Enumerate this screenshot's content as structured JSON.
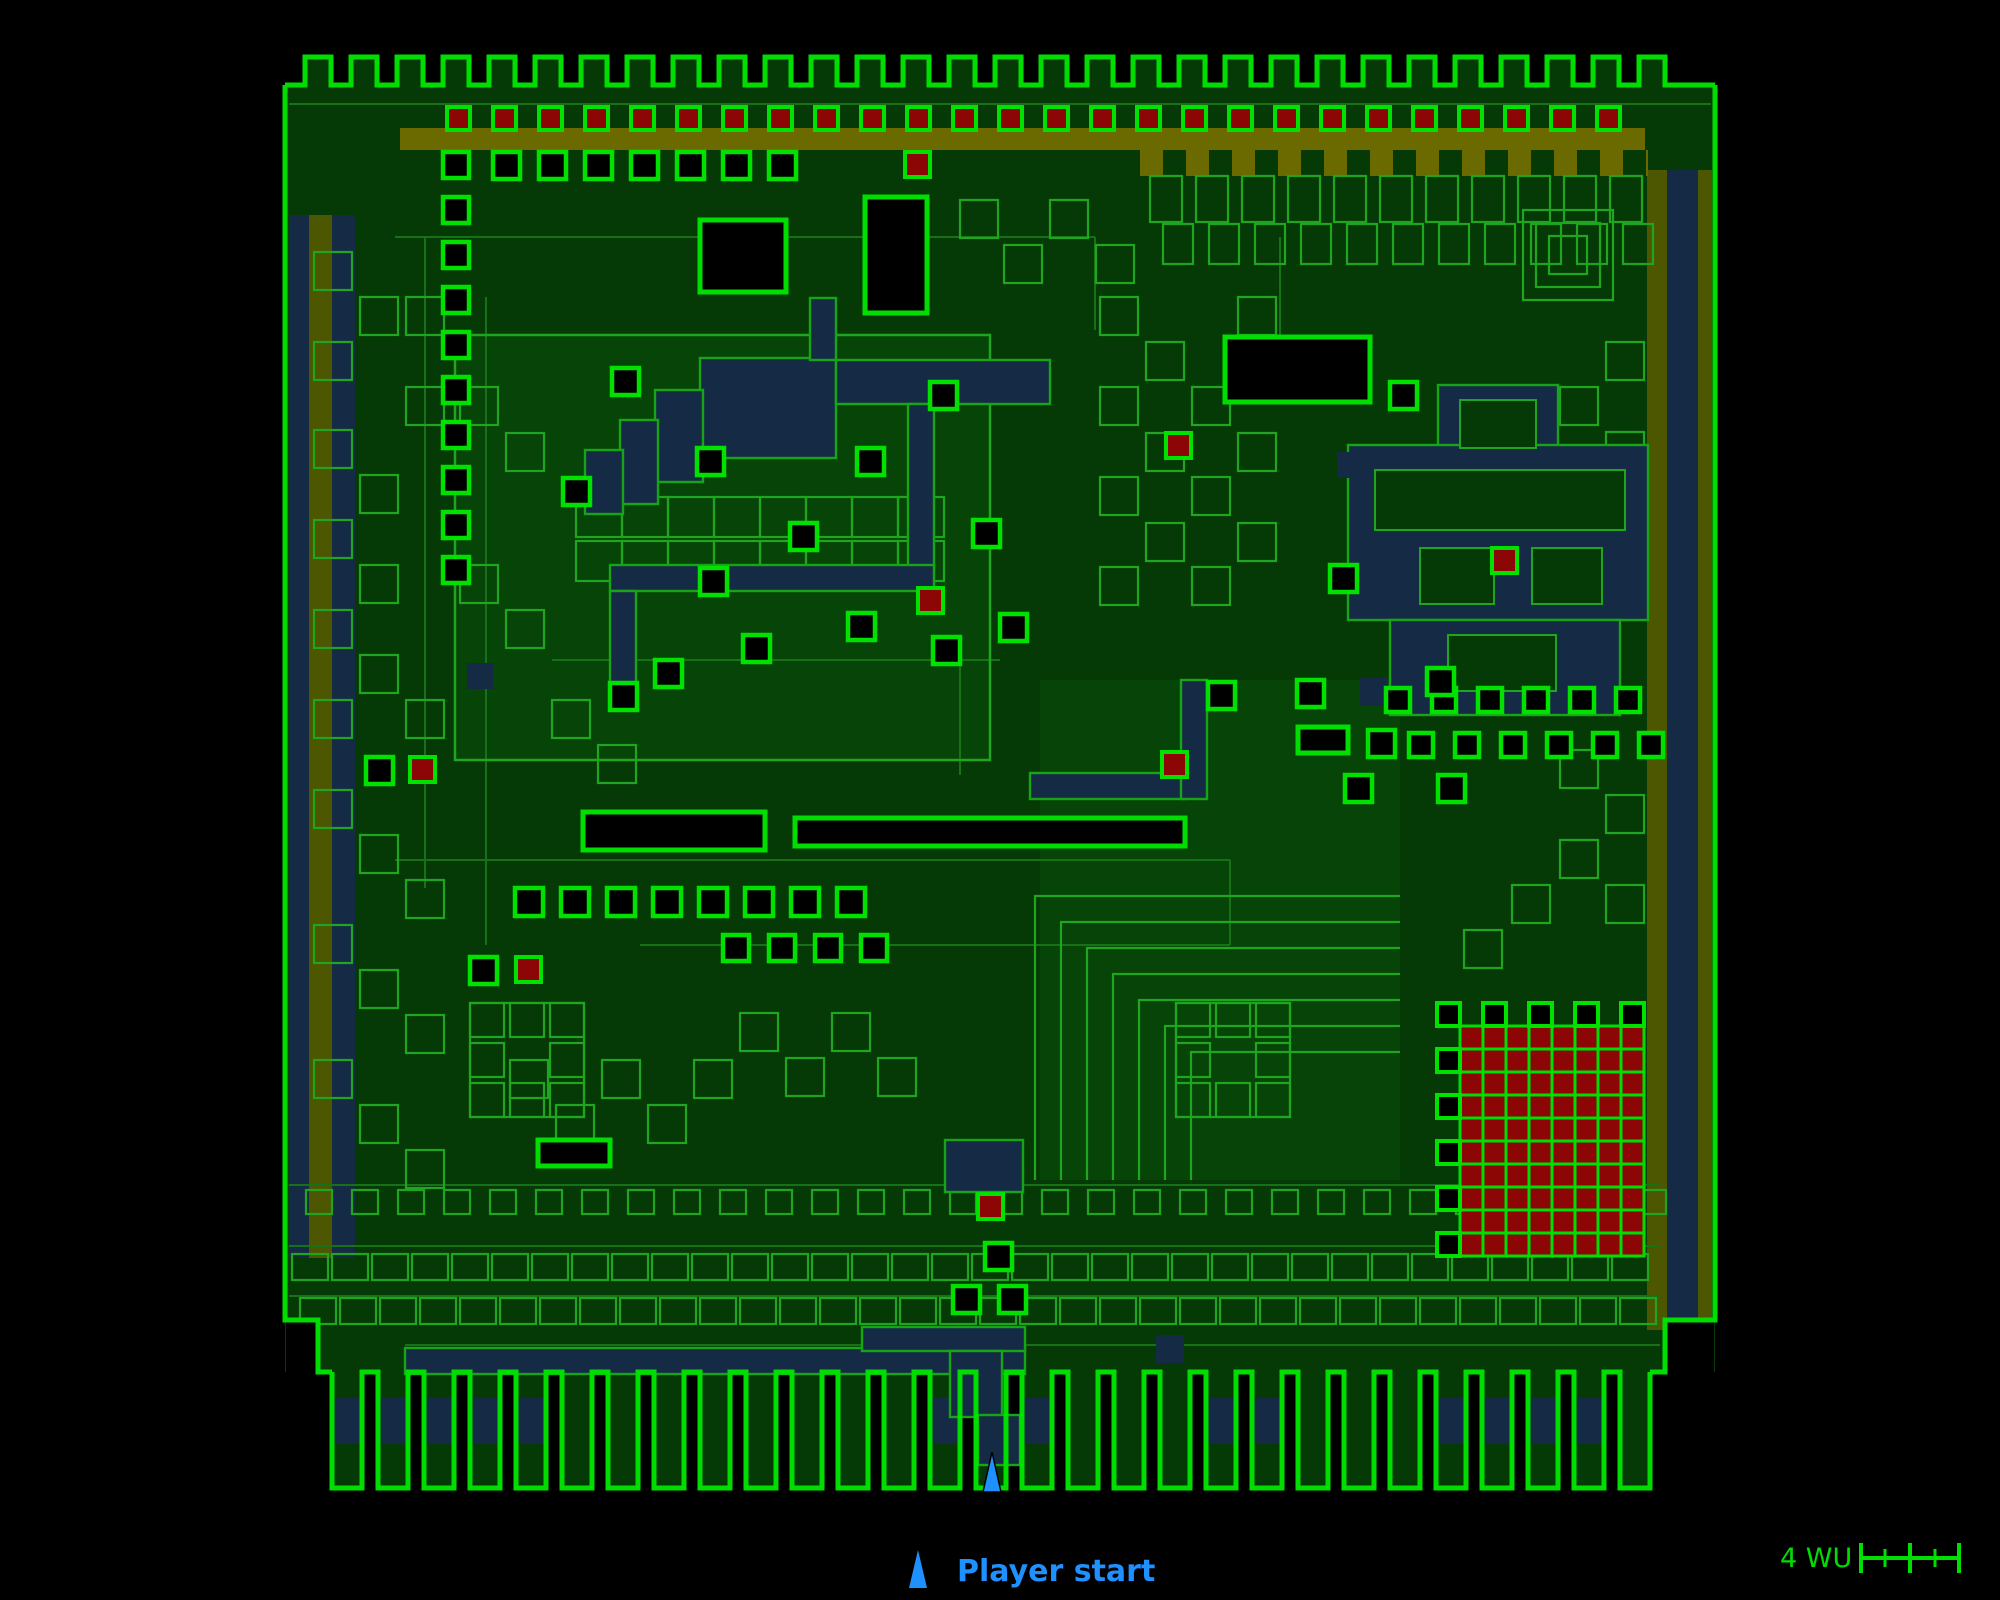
{
  "legend": {
    "label": "Player start"
  },
  "scalebar": {
    "label": "4 WU"
  },
  "map": {
    "colors": {
      "bg": "#000000",
      "floor": "#053a06",
      "floor_alt": "#064408",
      "bright": "#00dd00",
      "item_edge": "#00e100",
      "mid": "#1fa51f",
      "dim": "#177117",
      "water": "#152a45",
      "water_edge": "#17a517",
      "olive_band": "#6a6a00",
      "olive_strip": "#4d5600",
      "red": "#8d0606",
      "blue": "#1e90ff"
    },
    "frame": {
      "x": 285,
      "y": 85,
      "w": 1430,
      "h": 1287
    },
    "patches": [
      [
        455,
        335,
        535,
        425
      ],
      [
        1040,
        680,
        360,
        500
      ]
    ],
    "crenellation": {
      "x0": 285,
      "x1": 1715,
      "y_top": 57,
      "y_base": 85,
      "pitch": 46,
      "tab_w": 26,
      "lead": 20
    },
    "comb": {
      "x0": 332,
      "count": 29,
      "pitch": 46,
      "tooth_w": 30,
      "y_top": 1372,
      "y_bot": 1488,
      "band_y": 1398,
      "band_h": 46,
      "band_segments": [
        [
          335,
          565
        ],
        [
          900,
          1045
        ],
        [
          1180,
          1305
        ],
        [
          1440,
          1625
        ]
      ]
    },
    "strips": [
      [
        289,
        215,
        66,
        1043,
        "water"
      ],
      [
        309,
        215,
        23,
        1043,
        "olive_strip"
      ],
      [
        1647,
        170,
        20,
        1160,
        "olive_strip"
      ],
      [
        1667,
        170,
        31,
        1160,
        "water"
      ],
      [
        1698,
        170,
        14,
        1160,
        "olive_strip"
      ],
      [
        400,
        128,
        1245,
        22,
        "olive_band"
      ],
      [
        1140,
        150,
        508,
        26,
        "olive_band"
      ]
    ],
    "fringe_tabs": {
      "x0": 1163,
      "y": 150,
      "w": 23,
      "h": 26,
      "step": 46,
      "count": 11
    },
    "dim_lines": [
      [
        289,
        104,
        1711,
        104
      ],
      [
        425,
        237,
        425,
        888
      ],
      [
        486,
        297,
        486,
        945
      ],
      [
        395,
        237,
        1095,
        237
      ],
      [
        1095,
        237,
        1095,
        330
      ],
      [
        552,
        660,
        1000,
        660
      ],
      [
        395,
        860,
        1230,
        860
      ],
      [
        1230,
        860,
        1230,
        945
      ],
      [
        640,
        945,
        1230,
        945
      ],
      [
        289,
        1185,
        1660,
        1185
      ],
      [
        289,
        1246,
        1660,
        1246
      ],
      [
        289,
        1296,
        1660,
        1296
      ],
      [
        405,
        1345,
        1660,
        1345
      ],
      [
        960,
        660,
        960,
        775
      ],
      [
        1280,
        237,
        1280,
        337
      ]
    ],
    "compound_box": [
      455,
      335,
      535,
      425
    ],
    "dim_rows": [
      {
        "y": 176,
        "x0": 1150,
        "step": 46,
        "w": 32,
        "h": 46,
        "count": 11
      },
      {
        "y": 224,
        "x0": 1163,
        "step": 46,
        "w": 30,
        "h": 40,
        "count": 11
      },
      {
        "y": 497,
        "x0": 576,
        "step": 46,
        "w": 46,
        "h": 40,
        "count": 8
      },
      {
        "y": 541,
        "x0": 576,
        "step": 46,
        "w": 46,
        "h": 40,
        "count": 8
      },
      {
        "y": 1190,
        "x0": 306,
        "step": 46,
        "w": 26,
        "h": 24,
        "count": 30
      },
      {
        "y": 1254,
        "x0": 292,
        "step": 40,
        "w": 36,
        "h": 26,
        "count": 34
      },
      {
        "y": 1298,
        "x0": 300,
        "step": 40,
        "w": 36,
        "h": 26,
        "count": 34
      }
    ],
    "dim_squares": [
      [
        314,
        252
      ],
      [
        314,
        342
      ],
      [
        360,
        297
      ],
      [
        314,
        430
      ],
      [
        360,
        475
      ],
      [
        406,
        297
      ],
      [
        406,
        387
      ],
      [
        314,
        520
      ],
      [
        360,
        565
      ],
      [
        314,
        610
      ],
      [
        360,
        655
      ],
      [
        406,
        700
      ],
      [
        314,
        700
      ],
      [
        314,
        790
      ],
      [
        360,
        835
      ],
      [
        406,
        880
      ],
      [
        314,
        925
      ],
      [
        360,
        970
      ],
      [
        406,
        1015
      ],
      [
        314,
        1060
      ],
      [
        360,
        1105
      ],
      [
        406,
        1150
      ],
      [
        460,
        387
      ],
      [
        506,
        433
      ],
      [
        460,
        565
      ],
      [
        506,
        610
      ],
      [
        552,
        700
      ],
      [
        598,
        745
      ],
      [
        510,
        1060
      ],
      [
        556,
        1105
      ],
      [
        602,
        1060
      ],
      [
        648,
        1105
      ],
      [
        694,
        1060
      ],
      [
        740,
        1013
      ],
      [
        786,
        1058
      ],
      [
        832,
        1013
      ],
      [
        878,
        1058
      ],
      [
        1100,
        297
      ],
      [
        1146,
        342
      ],
      [
        1192,
        387
      ],
      [
        1238,
        297
      ],
      [
        1100,
        387
      ],
      [
        1146,
        433
      ],
      [
        1238,
        433
      ],
      [
        1100,
        477
      ],
      [
        1192,
        477
      ],
      [
        1146,
        523
      ],
      [
        1238,
        523
      ],
      [
        1100,
        567
      ],
      [
        1192,
        567
      ],
      [
        1606,
        342
      ],
      [
        1560,
        387
      ],
      [
        1606,
        432
      ],
      [
        1560,
        750
      ],
      [
        1606,
        795
      ],
      [
        1560,
        840
      ],
      [
        1512,
        885
      ],
      [
        1464,
        930
      ],
      [
        1606,
        885
      ],
      [
        1050,
        200
      ],
      [
        1096,
        245
      ],
      [
        960,
        200
      ],
      [
        1004,
        245
      ],
      [
        1523,
        210,
        90
      ],
      [
        1536,
        223,
        64
      ],
      [
        1549,
        236,
        38
      ]
    ],
    "rings": [
      [
        470,
        1003,
        114
      ],
      [
        1176,
        1003,
        114
      ]
    ],
    "nested_corners": {
      "x0": 1035,
      "y0": 896,
      "x_right": 1400,
      "y_bot": 1180,
      "step": 26,
      "count": 7
    },
    "water": [
      [
        700,
        358,
        136,
        100
      ],
      [
        655,
        390,
        48,
        92
      ],
      [
        620,
        420,
        38,
        84
      ],
      [
        585,
        450,
        38,
        64
      ],
      [
        810,
        298,
        26,
        62
      ],
      [
        836,
        360,
        214,
        44
      ],
      [
        908,
        404,
        26,
        165
      ],
      [
        610,
        565,
        324,
        26
      ],
      [
        610,
        591,
        26,
        112
      ],
      [
        1030,
        773,
        155,
        26
      ],
      [
        1181,
        680,
        26,
        119
      ],
      [
        1438,
        385,
        120,
        325
      ],
      [
        1348,
        445,
        300,
        175
      ],
      [
        1390,
        620,
        230,
        95
      ],
      [
        405,
        1348,
        620,
        26
      ],
      [
        862,
        1327,
        163,
        24
      ],
      [
        950,
        1351,
        52,
        66
      ],
      [
        978,
        1415,
        42,
        50
      ],
      [
        945,
        1140,
        78,
        52
      ]
    ],
    "water_plain": [
      [
        467,
        663,
        26,
        26
      ],
      [
        1337,
        452,
        26,
        26
      ],
      [
        1360,
        678,
        28,
        28
      ],
      [
        1156,
        1335,
        28,
        28
      ]
    ],
    "islands": [
      [
        1460,
        400,
        76,
        48
      ],
      [
        1375,
        470,
        250,
        60
      ],
      [
        1420,
        548,
        74,
        56
      ],
      [
        1532,
        548,
        70,
        56
      ],
      [
        1448,
        635,
        108,
        56
      ]
    ],
    "holes": [
      [
        700,
        220,
        86,
        72
      ],
      [
        865,
        197,
        62,
        116
      ],
      [
        1225,
        337,
        145,
        65
      ],
      [
        583,
        812,
        182,
        38
      ],
      [
        795,
        818,
        390,
        28
      ],
      [
        1298,
        727,
        50,
        26
      ],
      [
        538,
        1140,
        72,
        26
      ]
    ],
    "red_row": {
      "x0": 447,
      "y": 107,
      "size": 23,
      "step": 46,
      "count": 26
    },
    "item_rows": [
      {
        "x0": 493,
        "y": 152,
        "step": 46,
        "count": 7,
        "size": 27
      },
      {
        "x0": 1386,
        "y": 688,
        "step": 46,
        "count": 6,
        "size": 24
      },
      {
        "x0": 1409,
        "y": 733,
        "step": 46,
        "count": 6,
        "size": 24
      },
      {
        "x0": 515,
        "y": 888,
        "step": 46,
        "count": 8,
        "size": 28
      },
      {
        "x0": 723,
        "y": 935,
        "step": 46,
        "count": 4,
        "size": 26
      }
    ],
    "item_col": {
      "x": 443,
      "y0": 152,
      "step": 45,
      "count": 10,
      "size": 26
    },
    "items_black": [
      [
        612,
        368
      ],
      [
        697,
        448
      ],
      [
        857,
        448
      ],
      [
        930,
        382
      ],
      [
        790,
        523
      ],
      [
        973,
        520
      ],
      [
        700,
        568
      ],
      [
        655,
        660
      ],
      [
        743,
        635
      ],
      [
        848,
        613
      ],
      [
        933,
        637
      ],
      [
        1000,
        614
      ],
      [
        610,
        683
      ],
      [
        563,
        478
      ],
      [
        1390,
        382
      ],
      [
        1330,
        565
      ],
      [
        1297,
        680
      ],
      [
        1208,
        682
      ],
      [
        1368,
        730
      ],
      [
        1345,
        775
      ],
      [
        1438,
        775
      ],
      [
        1427,
        668
      ],
      [
        470,
        957
      ],
      [
        366,
        757
      ],
      [
        985,
        1243
      ],
      [
        953,
        1286
      ],
      [
        999,
        1286
      ]
    ],
    "items_red": [
      [
        905,
        152
      ],
      [
        918,
        588
      ],
      [
        516,
        957
      ],
      [
        410,
        757
      ],
      [
        1162,
        752
      ],
      [
        1492,
        548
      ],
      [
        978,
        1194
      ],
      [
        1166,
        433
      ]
    ],
    "red_grid": {
      "x": 1437,
      "y": 1003,
      "cell": 23,
      "black_cells": [
        [
          0,
          0
        ],
        [
          2,
          0
        ],
        [
          4,
          0
        ],
        [
          6,
          0
        ],
        [
          8,
          0
        ],
        [
          0,
          2
        ],
        [
          0,
          4
        ],
        [
          0,
          6
        ],
        [
          0,
          8
        ],
        [
          0,
          10
        ]
      ],
      "red_cols": [
        1,
        8
      ],
      "red_rows": [
        1,
        10
      ]
    },
    "corner_patches": [
      [
        286,
        1321,
        31,
        51
      ],
      [
        1666,
        1321,
        48,
        51
      ]
    ],
    "start_marker": {
      "points": "983,1492 1001,1492 992,1452"
    }
  }
}
